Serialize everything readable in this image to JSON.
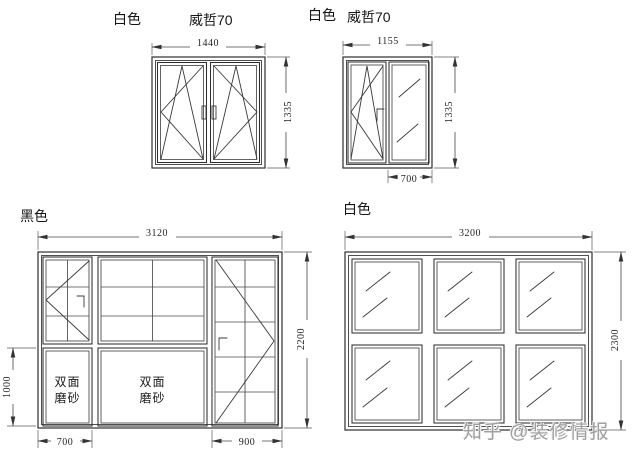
{
  "page": {
    "background": "#ffffff"
  },
  "colors": {
    "line": "#2d2d2d",
    "grid": "#4a4a4a",
    "dimension": "#474747",
    "text": "#141414",
    "watermark": "#a0a0a0"
  },
  "drawings": {
    "top_left": {
      "color_label": "白色",
      "brand_label": "威哲70",
      "dim_width": "1440",
      "dim_height": "1335"
    },
    "top_right": {
      "color_label": "白色",
      "brand_label": "威哲70",
      "dim_width": "1155",
      "dim_height": "1335",
      "dim_fixed_width": "700"
    },
    "bottom_left": {
      "color_label": "黑色",
      "dim_width": "3120",
      "dim_height": "2200",
      "dim_band_height": "1000",
      "dim_left_width": "700",
      "dim_right_width": "900",
      "frosted_line1": "双面",
      "frosted_line2": "磨砂"
    },
    "bottom_right": {
      "color_label": "白色",
      "dim_width": "3200",
      "dim_height": "2300"
    }
  },
  "watermark": {
    "text": "知乎 @装修情报"
  }
}
